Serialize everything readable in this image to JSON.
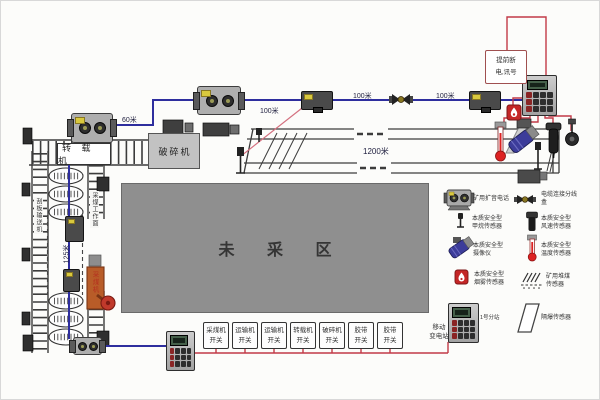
{
  "areas": {
    "unmined": "未 采 区"
  },
  "machines": {
    "transfer": "转 载 机",
    "crusher": "破碎机",
    "shearer": "采煤机"
  },
  "roadways": {
    "left_ladder": "刮板输送机",
    "right_ladder": "采煤工作面"
  },
  "distances": {
    "d60": "60米",
    "d100a": "100米",
    "d100b": "100米",
    "d100c": "100米",
    "d1200": "1200米",
    "d125": "125米"
  },
  "notes": {
    "signal_line1": "提前断",
    "signal_line2": "电,讯号",
    "substation_line1": "移动",
    "substation_line2": "变电站",
    "station1": "1号分站",
    "screen_sensor": "隔爆传感器"
  },
  "switches": [
    {
      "name": "采煤机",
      "sub": "开关"
    },
    {
      "name": "运输机",
      "sub": "开关"
    },
    {
      "name": "运输机",
      "sub": "开关"
    },
    {
      "name": "转载机",
      "sub": "开关"
    },
    {
      "name": "破碎机",
      "sub": "开关"
    },
    {
      "name": "胶带",
      "sub": "开关"
    },
    {
      "name": "胶带",
      "sub": "开关"
    }
  ],
  "legend": [
    {
      "icon": "speaker-phone-icon",
      "line1": "矿用扩音电话",
      "line2": ""
    },
    {
      "icon": "cable-junction-icon",
      "line1": "电缆连接分线",
      "line2": "盒"
    },
    {
      "icon": "methane-sensor-icon",
      "line1": "本质安全型",
      "line2": "甲烷传感器"
    },
    {
      "icon": "wind-speed-sensor-icon",
      "line1": "本质安全型",
      "line2": "风速传感器"
    },
    {
      "icon": "camera-icon",
      "line1": "本质安全型",
      "line2": "摄像仪"
    },
    {
      "icon": "temperature-sensor-icon",
      "line1": "本质安全型",
      "line2": "温度传感器"
    },
    {
      "icon": "smoke-sensor-icon",
      "line1": "本质安全型",
      "line2": "烟雾传感器"
    },
    {
      "icon": "coal-pile-sensor-icon",
      "line1": "矿用堆煤",
      "line2": "传感器"
    }
  ],
  "colors": {
    "cable_blue": "#2e2e9e",
    "cable_red": "#c23a47",
    "structure_gray": "#aeaeae",
    "unmined_gray": "#8f8f8f",
    "shearer_orange": "#b85c28",
    "alarm_red": "#c42626"
  }
}
